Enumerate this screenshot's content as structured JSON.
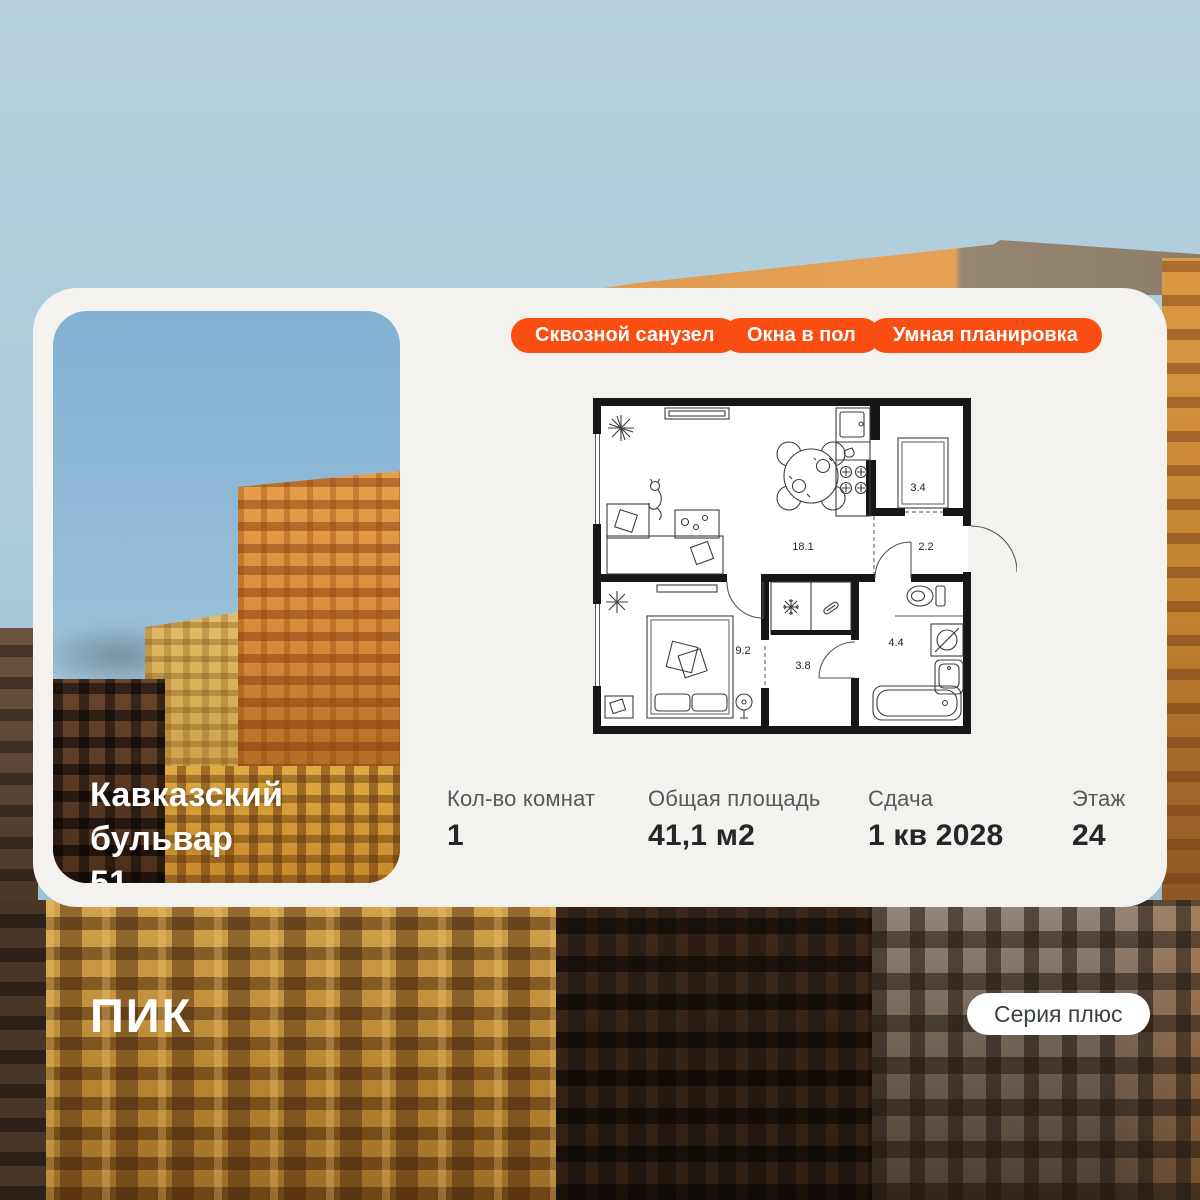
{
  "colors": {
    "accent": "#F94D12",
    "card_bg": "#F3F2EE",
    "badge_text": "#FFFFFF",
    "stat_label": "#55585C",
    "stat_value": "#24272A"
  },
  "card": {
    "title": {
      "line1": "Кавказский бульвар",
      "line2": "51"
    },
    "badges": [
      {
        "label": "Сквозной санузел"
      },
      {
        "label": "Окна в пол"
      },
      {
        "label": "Умная планировка"
      }
    ],
    "floor_plan": {
      "areas": {
        "living": "18.1",
        "wardrobe": "3.4",
        "hallway": "2.2",
        "bedroom": "9.2",
        "corridor": "3.8",
        "bathroom": "4.4"
      }
    },
    "stats": [
      {
        "label": "Кол-во комнат",
        "value": "1"
      },
      {
        "label": "Общая площадь",
        "value": "41,1 м2"
      },
      {
        "label": "Сдача",
        "value": "1 кв 2028"
      },
      {
        "label": "Этаж",
        "value": "24"
      }
    ]
  },
  "footer": {
    "logo": "ПИК",
    "series": "Серия плюс"
  }
}
